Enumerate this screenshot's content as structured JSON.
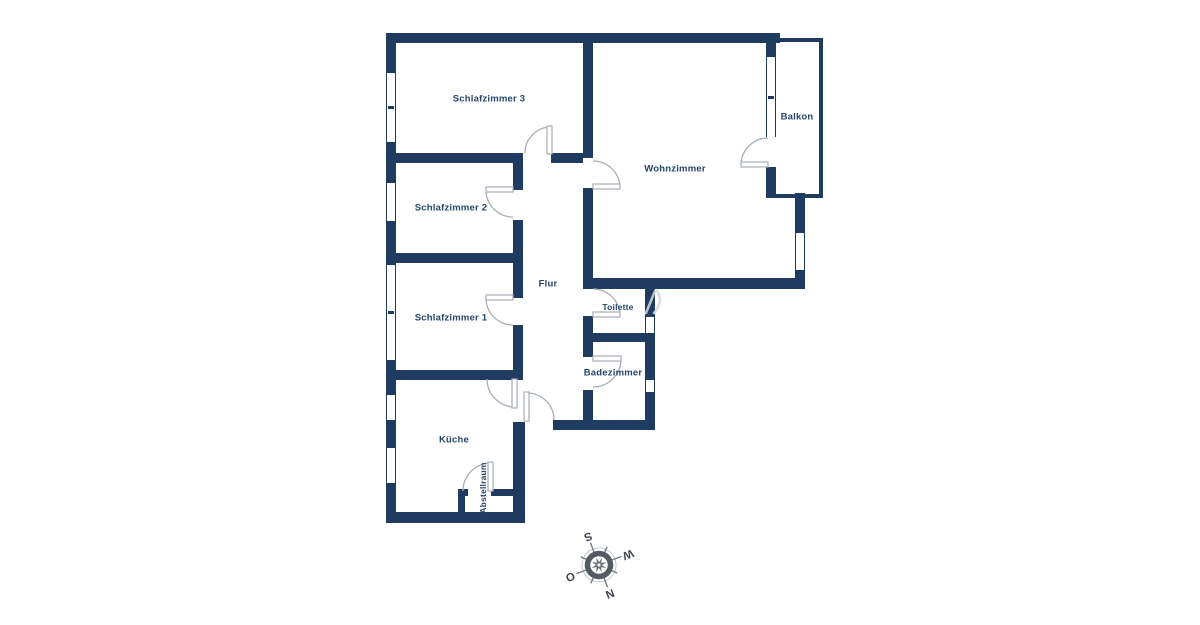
{
  "floorplan": {
    "rooms": [
      {
        "label": "Schlafzimmer 3"
      },
      {
        "label": "Schlafzimmer 2"
      },
      {
        "label": "Schlafzimmer 1"
      },
      {
        "label": "Wohnzimmer"
      },
      {
        "label": "Balkon"
      },
      {
        "label": "Flur"
      },
      {
        "label": "Toilette"
      },
      {
        "label": "Badezimmer"
      },
      {
        "label": "Küche"
      },
      {
        "label": "Abstellraum"
      }
    ],
    "compass": {
      "letters": {
        "n": "N",
        "e": "O",
        "s": "S",
        "w": "W"
      },
      "rotation_deg": 159
    },
    "colors": {
      "wall": "#1f3c60",
      "label_text": "#25456a",
      "door_arc": "#a8aeb6",
      "compass_letter": "#42474f",
      "background": "#ffffff"
    }
  }
}
